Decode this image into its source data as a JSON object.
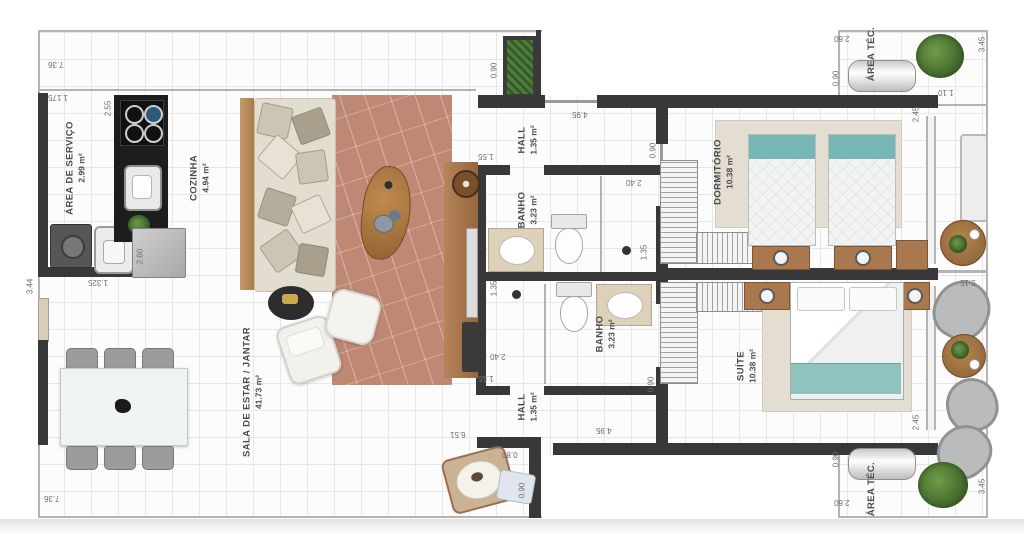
{
  "rooms": {
    "area_servico": {
      "name": "ÁREA DE SERVIÇO",
      "area": "2.99 m²"
    },
    "cozinha": {
      "name": "COZINHA",
      "area": "4.94 m²"
    },
    "sala": {
      "name": "SALA DE ESTAR / JANTAR",
      "area": "41.73 m²"
    },
    "hall_superior": {
      "name": "HALL",
      "area": "1.35 m²"
    },
    "banho_superior": {
      "name": "BANHO",
      "area": "3.23 m²"
    },
    "banho_inferior": {
      "name": "BANHO",
      "area": "3.23 m²"
    },
    "hall_inferior": {
      "name": "HALL",
      "area": "1.35 m²"
    },
    "dormitorio": {
      "name": "DORMITÓRIO",
      "area": "10.38 m²"
    },
    "suite": {
      "name": "SUÍTE",
      "area": "10.38 m²"
    },
    "area_tec_superior": {
      "name": "ÁREA TÉC."
    },
    "area_tec_inferior": {
      "name": "ÁREA TÉC."
    }
  },
  "dims": [
    "7.36",
    "1.175",
    "2.55",
    "3.44",
    "1.325",
    "2.60",
    "0.90",
    "4.95",
    "1.55",
    "0.90",
    "2.40",
    "1.35",
    "2.45",
    "1.10",
    "3.45",
    "2.60",
    "0.90",
    "5.15",
    "1.55",
    "1.35",
    "2.40",
    "0.90",
    "4.95",
    "6.51",
    "0.80",
    "0.90",
    "2.45",
    "0.90",
    "2.60",
    "3.45",
    "7.36"
  ],
  "colors": {
    "wall": "#383838",
    "rug": "#bf8875",
    "wood": "#ad7b4e",
    "bed_teal": "#77b7b3",
    "sofa": "#e3ddcf",
    "plant_green": "#5b8a3c"
  }
}
